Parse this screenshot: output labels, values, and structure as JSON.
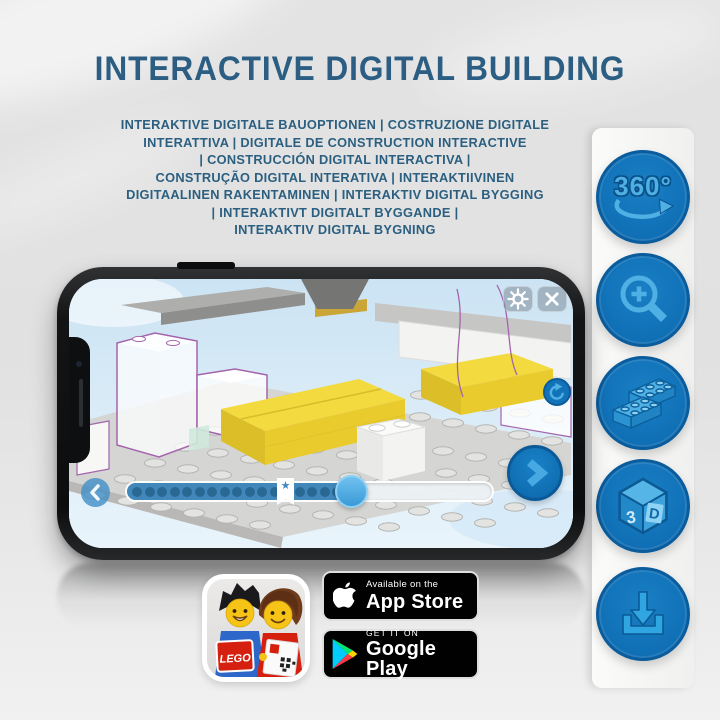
{
  "title": "INTERACTIVE DIGITAL BUILDING",
  "subtitle_lines": [
    "INTERAKTIVE DIGITALE BAUOPTIONEN | COSTRUZIONE DIGITALE",
    "INTERATTIVA | DIGITALE DE CONSTRUCTION INTERACTIVE",
    "| CONSTRUCCIÓN DIGITAL INTERACTIVA |",
    "CONSTRUÇÃO DIGITAL INTERATIVA | INTERAKTIIVINEN",
    "DIGITAALINEN RAKENTAMINEN | INTERAKTIV DIGITAL BYGGING",
    "| INTERAKTIVT DIGITALT BYGGANDE |",
    "INTERAKTIV DIGITAL BYGNING"
  ],
  "feature_panel": {
    "items": [
      {
        "name": "360-rotation",
        "label": "360°"
      },
      {
        "name": "zoom-in",
        "label": ""
      },
      {
        "name": "building-bricks",
        "label": ""
      },
      {
        "name": "3d-view",
        "label_left": "3",
        "label_right": "D"
      },
      {
        "name": "download",
        "label": ""
      }
    ]
  },
  "phone_app": {
    "progress_dots": 18,
    "progress_percent": 62,
    "bookmark_percent": 43
  },
  "app_badges": {
    "lego_logo_text": "LEGO",
    "app_store": {
      "tagline": "Available on the",
      "store": "App Store"
    },
    "google_play": {
      "tagline": "GET IT ON",
      "store": "Google Play"
    }
  },
  "colors": {
    "title_blue": "#2b5e82",
    "icon_circle_blue": "#1172b8",
    "icon_glyph_blue": "#4fb0e4",
    "brick_yellow": "#f2da3f",
    "lego_red": "#d6200f",
    "outline_purple": "#a464ac"
  }
}
